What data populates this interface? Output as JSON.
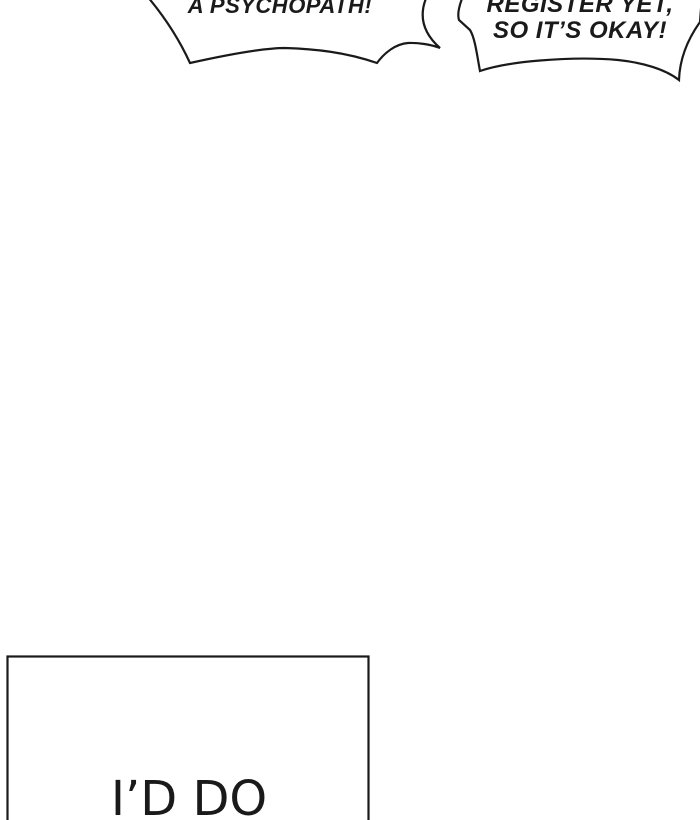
{
  "colors": {
    "paper": "#ffffff",
    "ink": "#1a1a1a"
  },
  "comic": {
    "speech_bubbles": [
      {
        "name": "left",
        "text": "A PSYCHOPATH!"
      },
      {
        "name": "right",
        "lines": [
          "REGISTER YET,",
          "SO IT’S OKAY!"
        ]
      }
    ],
    "panel": {
      "text": "I’D DO"
    }
  }
}
